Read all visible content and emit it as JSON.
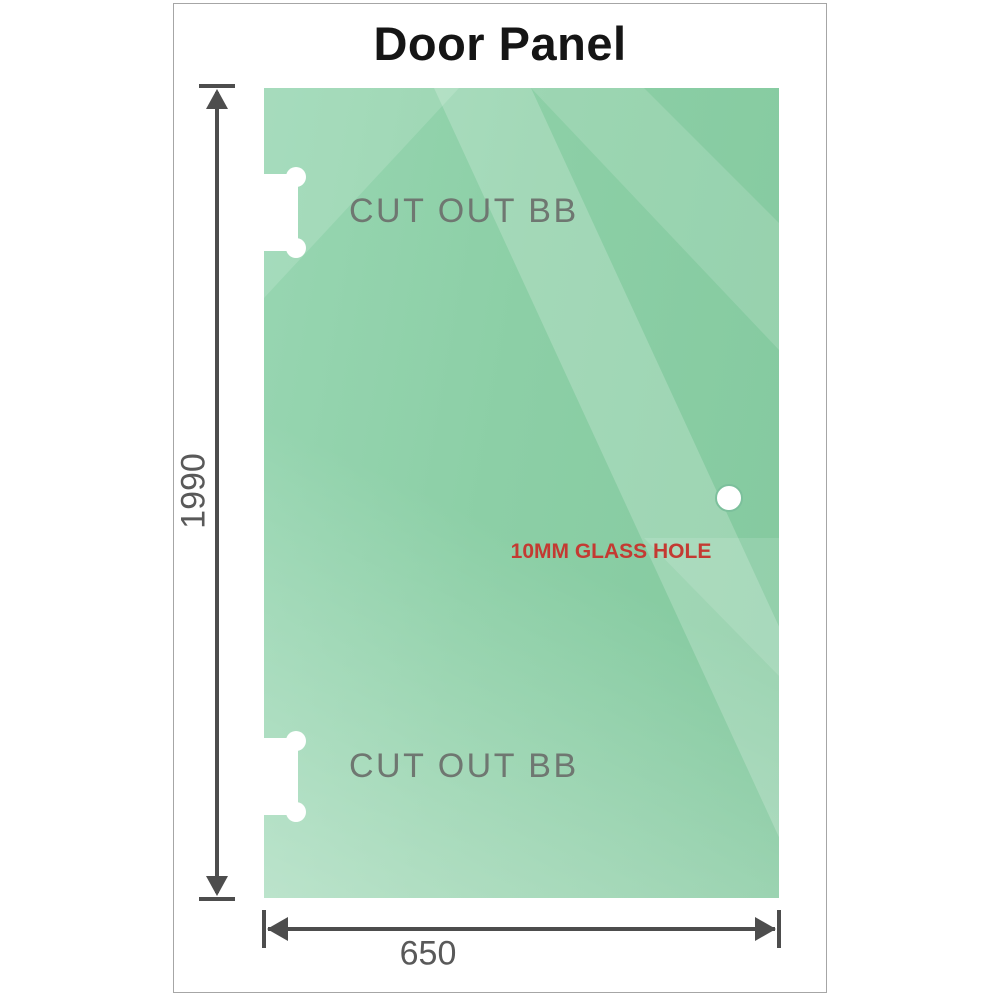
{
  "title": "Door Panel",
  "glass": {
    "color": "#8ccfa6",
    "cutouts": [
      {
        "label": "CUT OUT BB"
      },
      {
        "label": "CUT OUT BB"
      }
    ],
    "hole": {
      "label": "10MM GLASS HOLE",
      "label_color": "#c43a32"
    }
  },
  "dimensions": {
    "height": "1990",
    "width": "650",
    "line_color": "#4d4d4d"
  }
}
